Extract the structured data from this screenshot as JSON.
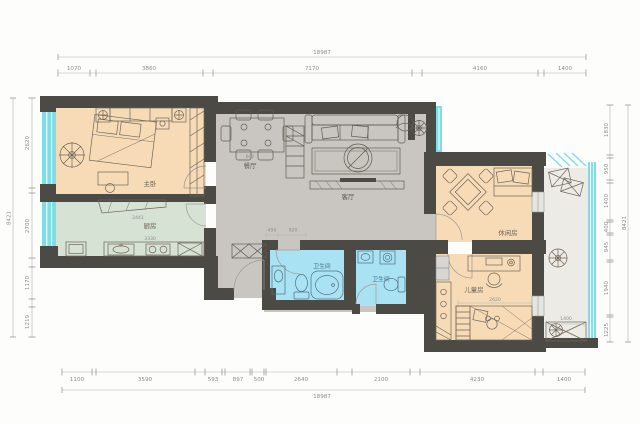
{
  "plan_labels": {
    "master_bedroom": "主卧",
    "kitchen": "厨房",
    "dining": "餐厅",
    "living": "客厅",
    "bath1": "卫生间",
    "bath2": "卫生间",
    "leisure": "休闲房",
    "kids": "儿童房"
  },
  "inner_dims": {
    "dining": "600",
    "kitchen_counter": "2441",
    "kitchen_width": "3330",
    "hall_a": "490",
    "hall_b": "920",
    "kids_bed": "2620",
    "balcony": "1400"
  },
  "dims": {
    "top_total": "18987",
    "top": [
      "1070",
      "3860",
      "7170",
      "4160",
      "1400"
    ],
    "bottom": [
      "1100",
      "3590",
      "593",
      "897",
      "500",
      "2640",
      "2100",
      "4230",
      "1400"
    ],
    "bottom_total": "18987",
    "left": [
      "2620",
      "2700",
      "1170",
      "1219"
    ],
    "left_total": "8421",
    "right": [
      "1830",
      "950",
      "1400",
      "400",
      "945",
      "1940",
      "1225"
    ],
    "right_total": "8421"
  },
  "colors": {
    "wall": "#4b4a45",
    "bedroom_fill": "#f6dbb6",
    "living_fill": "#c9c5c0",
    "kitchen_fill": "#d6e2d4",
    "bath_fill": "#a9e2f3",
    "window": "#7edde6",
    "balcony_fill": "#edebe6"
  }
}
